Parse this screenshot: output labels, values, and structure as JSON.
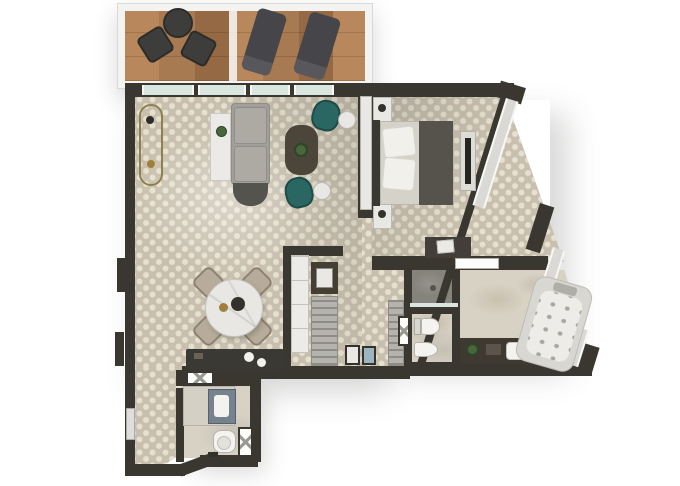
{
  "document_kind": "apartment-floor-plan-render",
  "colors": {
    "wall": "#39372f",
    "carpet-base": "#c8bfae",
    "carpet-dot": "#e6e0ce",
    "wood-a": "#a87a51",
    "wood-b": "#946943",
    "wood-c": "#b8885c",
    "balcony-frame": "#f3f3f1",
    "glass": "#d9e6e0",
    "window-pane": "#dad9d5",
    "window-frame": "#f7f7f5",
    "sofa": "#a29f99",
    "sofa-cushion": "#adaaa4",
    "sofa-dark": "#55534d",
    "console-white": "#ebeae6",
    "coffee-table": "#4b453a",
    "teal": "#2a6662",
    "marble-white": "#e8e7e3",
    "dining-chair": "#b7ac99",
    "counter-dark": "#3b3933",
    "wardrobe": "#ecebe8",
    "cabinet": "#443e33",
    "shelf": "#b5b3ad",
    "rung": "#8e8c85",
    "marble-floor": "#d8d2c5",
    "marble-dark": "#86837c",
    "fixture": "#f4f3ef",
    "vanity-dark": "#3e3a32",
    "sink-blue": "#76828d",
    "jacuzzi-outer": "#d9d7d1",
    "jacuzzi-inner": "#edece8",
    "jet": "#a8a6a0",
    "mattress": "#d5d2ca",
    "runner": "#55534c",
    "pillow": "#f1f0ea",
    "headboard": "#3a3832",
    "bench": "#433f38",
    "towel": "#eceae4",
    "plant": "#49663c",
    "plant-dark": "#2f4526",
    "brass": "#a07f3a",
    "door-white": "#fdfdfa",
    "door-line": "#9a9a94",
    "appliance-blue": "#9db5c0",
    "tv-screen": "#27251f",
    "nightstand": "#e9e8e4",
    "lounger": "#45454a",
    "patio-furniture": "#3d3d3b"
  },
  "rooms": [
    {
      "name": "balcony",
      "floor": "wood planks",
      "furniture": [
        "bistro chair",
        "bistro chair",
        "round table",
        "sun lounger",
        "sun lounger"
      ]
    },
    {
      "name": "living-room",
      "floor": "patterned carpet",
      "furniture": [
        "sofa",
        "sofa console",
        "wall console",
        "coffee table with plant",
        "teal armchair",
        "teal armchair",
        "marble side table",
        "marble side table"
      ]
    },
    {
      "name": "dining-area",
      "floor": "patterned carpet",
      "furniture": [
        "round marble dining table",
        "dining chair x4",
        "bar counter with sinks"
      ]
    },
    {
      "name": "bedroom",
      "floor": "patterned carpet",
      "furniture": [
        "double bed",
        "nightstand",
        "nightstand",
        "tv unit",
        "bench with towel",
        "built-in wardrobe"
      ]
    },
    {
      "name": "wardrobe-corridor",
      "furniture": [
        "white wardrobe",
        "minibar cabinet",
        "open shelving",
        "luggage shelf",
        "appliances"
      ]
    },
    {
      "name": "bathroom",
      "floor": "marble",
      "furniture": [
        "walk-in shower",
        "toilet",
        "bidet",
        "vanity with basin and plant",
        "jacuzzi tub",
        "linen shelf"
      ]
    },
    {
      "name": "powder-room",
      "floor": "marble",
      "furniture": [
        "vanity with basin",
        "toilet"
      ]
    }
  ]
}
